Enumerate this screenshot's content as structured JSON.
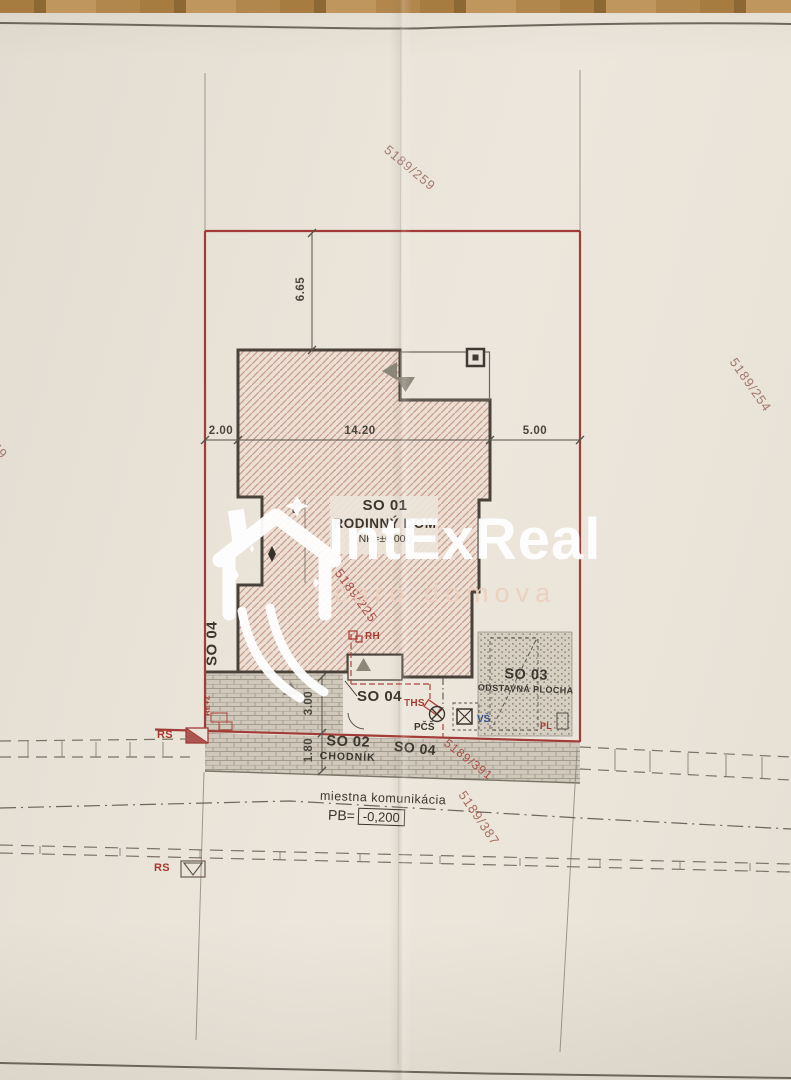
{
  "watermark": {
    "brand": "IntExReal",
    "tagline": "čaro domova"
  },
  "parcels": {
    "top": "5189/259",
    "right": "5189/254",
    "left": "5189/49",
    "plot": "5189/225",
    "sidewalk": "5189/391",
    "road": "5189/387"
  },
  "dimensions": {
    "front_setback": "6.65",
    "side_left": "2.00",
    "building_width": "14.20",
    "side_right": "5.00",
    "rear_yard": "3.00",
    "sidewalk": "1.80",
    "notch": "85"
  },
  "buildings": {
    "so01_code": "SO 01",
    "so01_name": "RODINNÝ DOM",
    "so01_level": "NP=±0,000",
    "so02_code": "SO 02",
    "so02_name": "CHODNÍK",
    "so03_code": "SO 03",
    "so03_name": "ODSTAVNÁ PLOCHA",
    "so04_code": "SO 04"
  },
  "utilities": {
    "rh": "RH",
    "ths": "THS",
    "pcs": "PČŠ",
    "vs": "VŠ",
    "pl": "PL",
    "rs": "RS",
    "rez": "RE+Z"
  },
  "road": {
    "name": "miestna komunikácia",
    "pb_label": "PB=",
    "pb_value": "-0,200"
  },
  "colors": {
    "boundary_red": "#a23c38",
    "annotation_red": "#b0443c",
    "parcel_brown": "#97655a",
    "ink": "#3b362e",
    "blue": "#37508e",
    "paper": "#e9e3d9"
  }
}
